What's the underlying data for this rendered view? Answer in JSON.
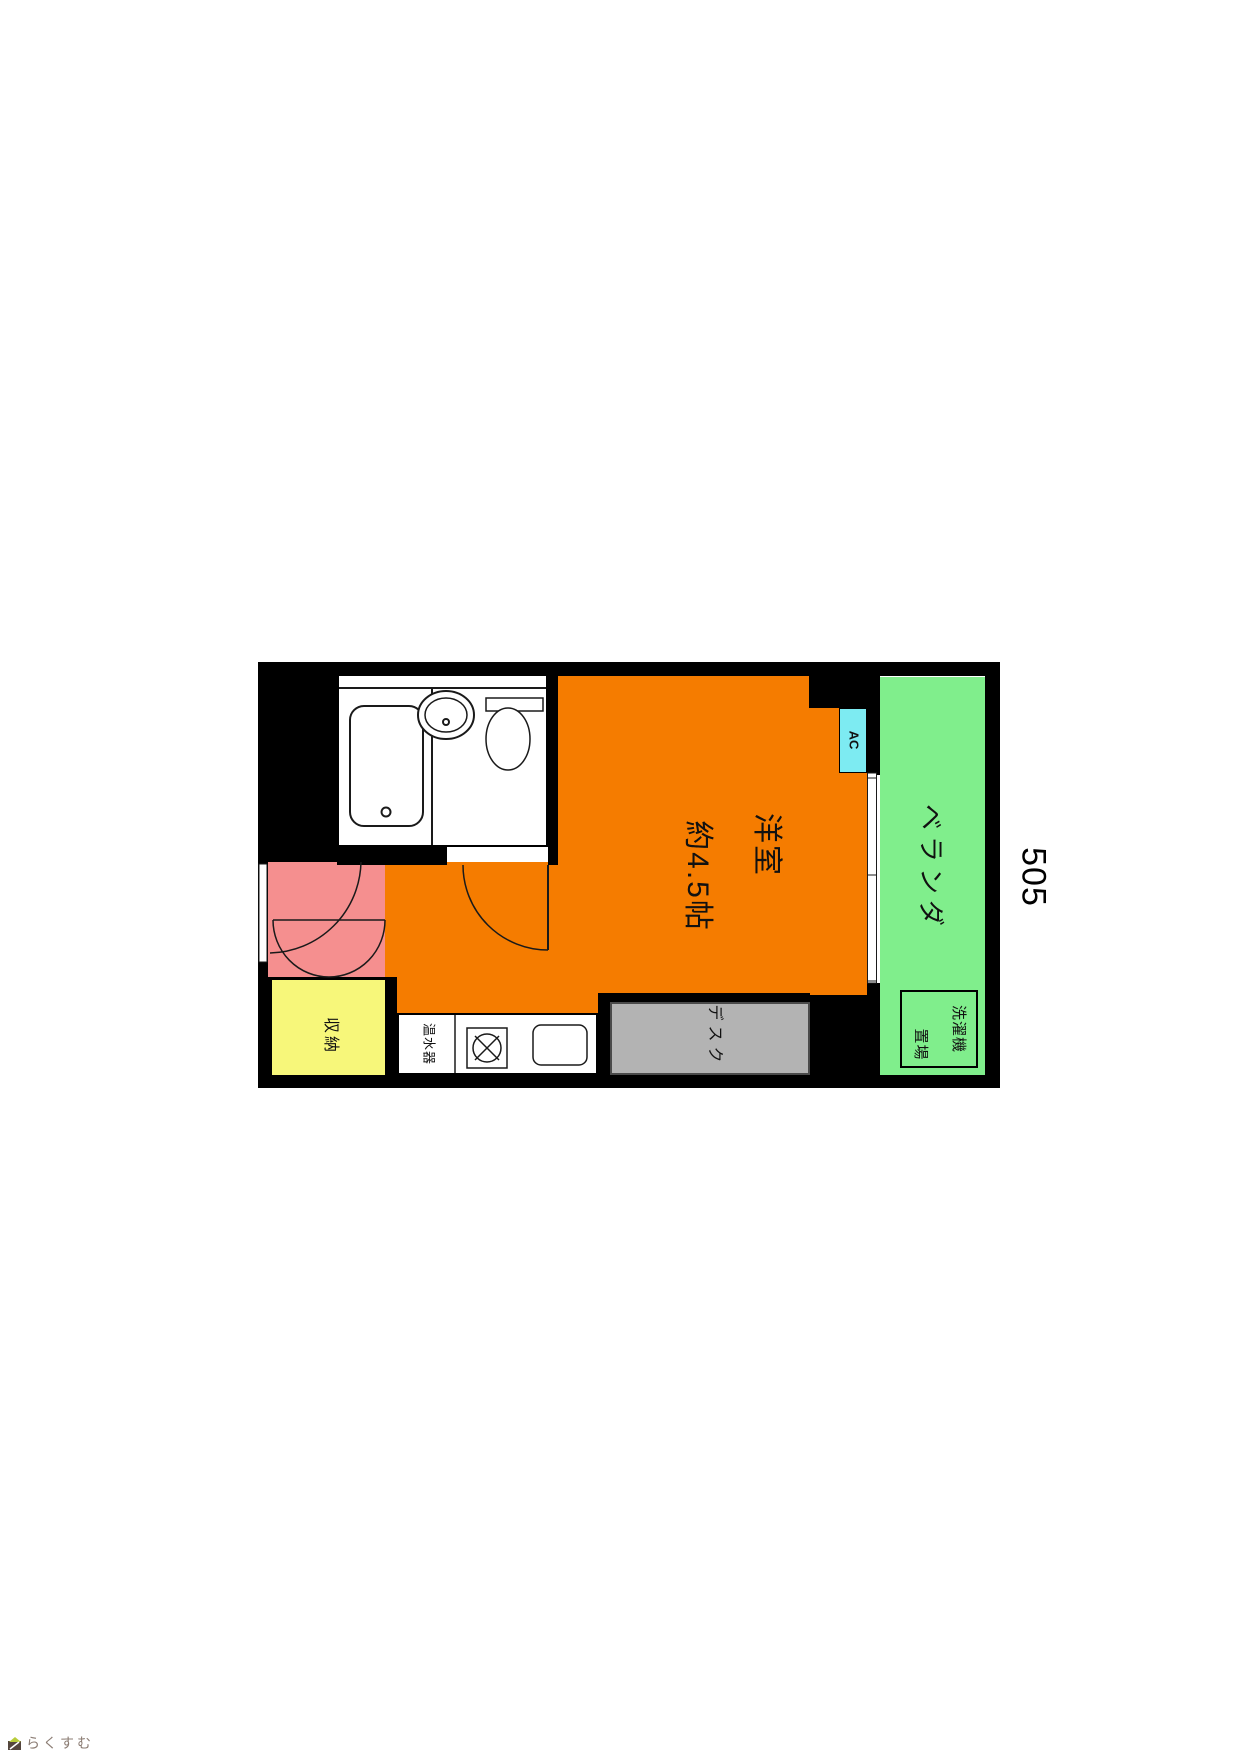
{
  "floor_plan": {
    "unit_number": "505",
    "rooms": {
      "western_room": {
        "label_line1": "洋室",
        "label_line2": "約4.5帖",
        "color": "#F57C00"
      },
      "veranda": {
        "label": "ベランダ",
        "color": "#80EE8C"
      },
      "entrance": {
        "color": "#F58F8F"
      },
      "storage": {
        "label": "収納",
        "color": "#F7F77A"
      },
      "desk": {
        "label": "デスク",
        "color": "#B3B3B3"
      },
      "water_heater": {
        "label": "温水器"
      },
      "ac": {
        "label": "AC",
        "color": "#7DEBF2"
      },
      "washing_machine": {
        "label_line1": "洗濯機",
        "label_line2": "置場"
      }
    },
    "wall_color": "#000000"
  },
  "footer": {
    "logo_text": "らくすむ"
  }
}
